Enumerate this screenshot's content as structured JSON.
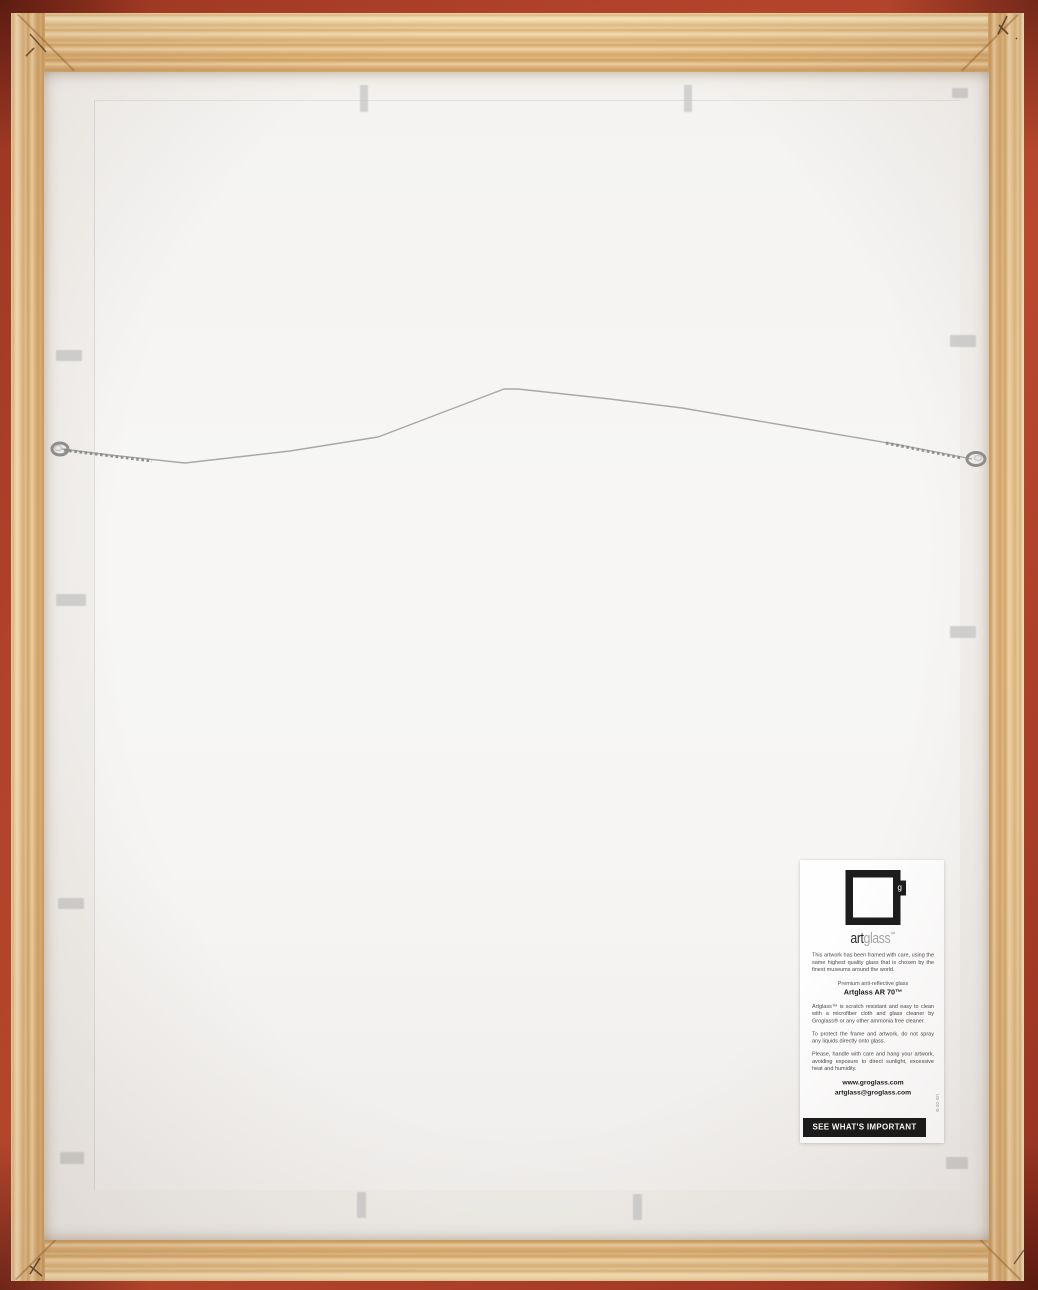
{
  "label": {
    "brand": {
      "art": "art",
      "glass": "glass",
      "tm": "™",
      "logo_letter": "g"
    },
    "intro": "This artwork has been framed with care, using the same highest quality glass that is chosen by the finest museums around the world.",
    "product_tagline": "Premium anti-reflective glass",
    "product_name": "Artglass AR 70™",
    "care_cleaning": "Artglass™ is scratch resistant and easy to clean with a microfiber cloth and glass cleaner by Groglass® or any other ammonia free cleaner.",
    "care_protect": "To protect the frame and artwork, do not spray any liquids directly onto glass.",
    "care_handle": "Please, handle with care and hang your artwork, avoiding exposure to direct sunlight, excessive heat and humidity.",
    "website": "www.groglass.com",
    "email": "artglass@groglass.com",
    "slogan": "SEE WHAT'S IMPORTANT",
    "item_code": "UE-02-B"
  },
  "colors": {
    "frame_red": "#b5432c",
    "frame_red_dark": "#7e2718",
    "wood_light": "#f2d9ab",
    "wood_mid": "#e4bd85",
    "wood_dark": "#d9ad72",
    "backing": "#f1efec",
    "board": "#f6f5f3",
    "wire": "#a8a8a8",
    "label_bg": "#fefefe",
    "label_text": "#4a4a4a",
    "slogan_bg": "#1b1b1b",
    "slogan_text": "#ffffff"
  }
}
